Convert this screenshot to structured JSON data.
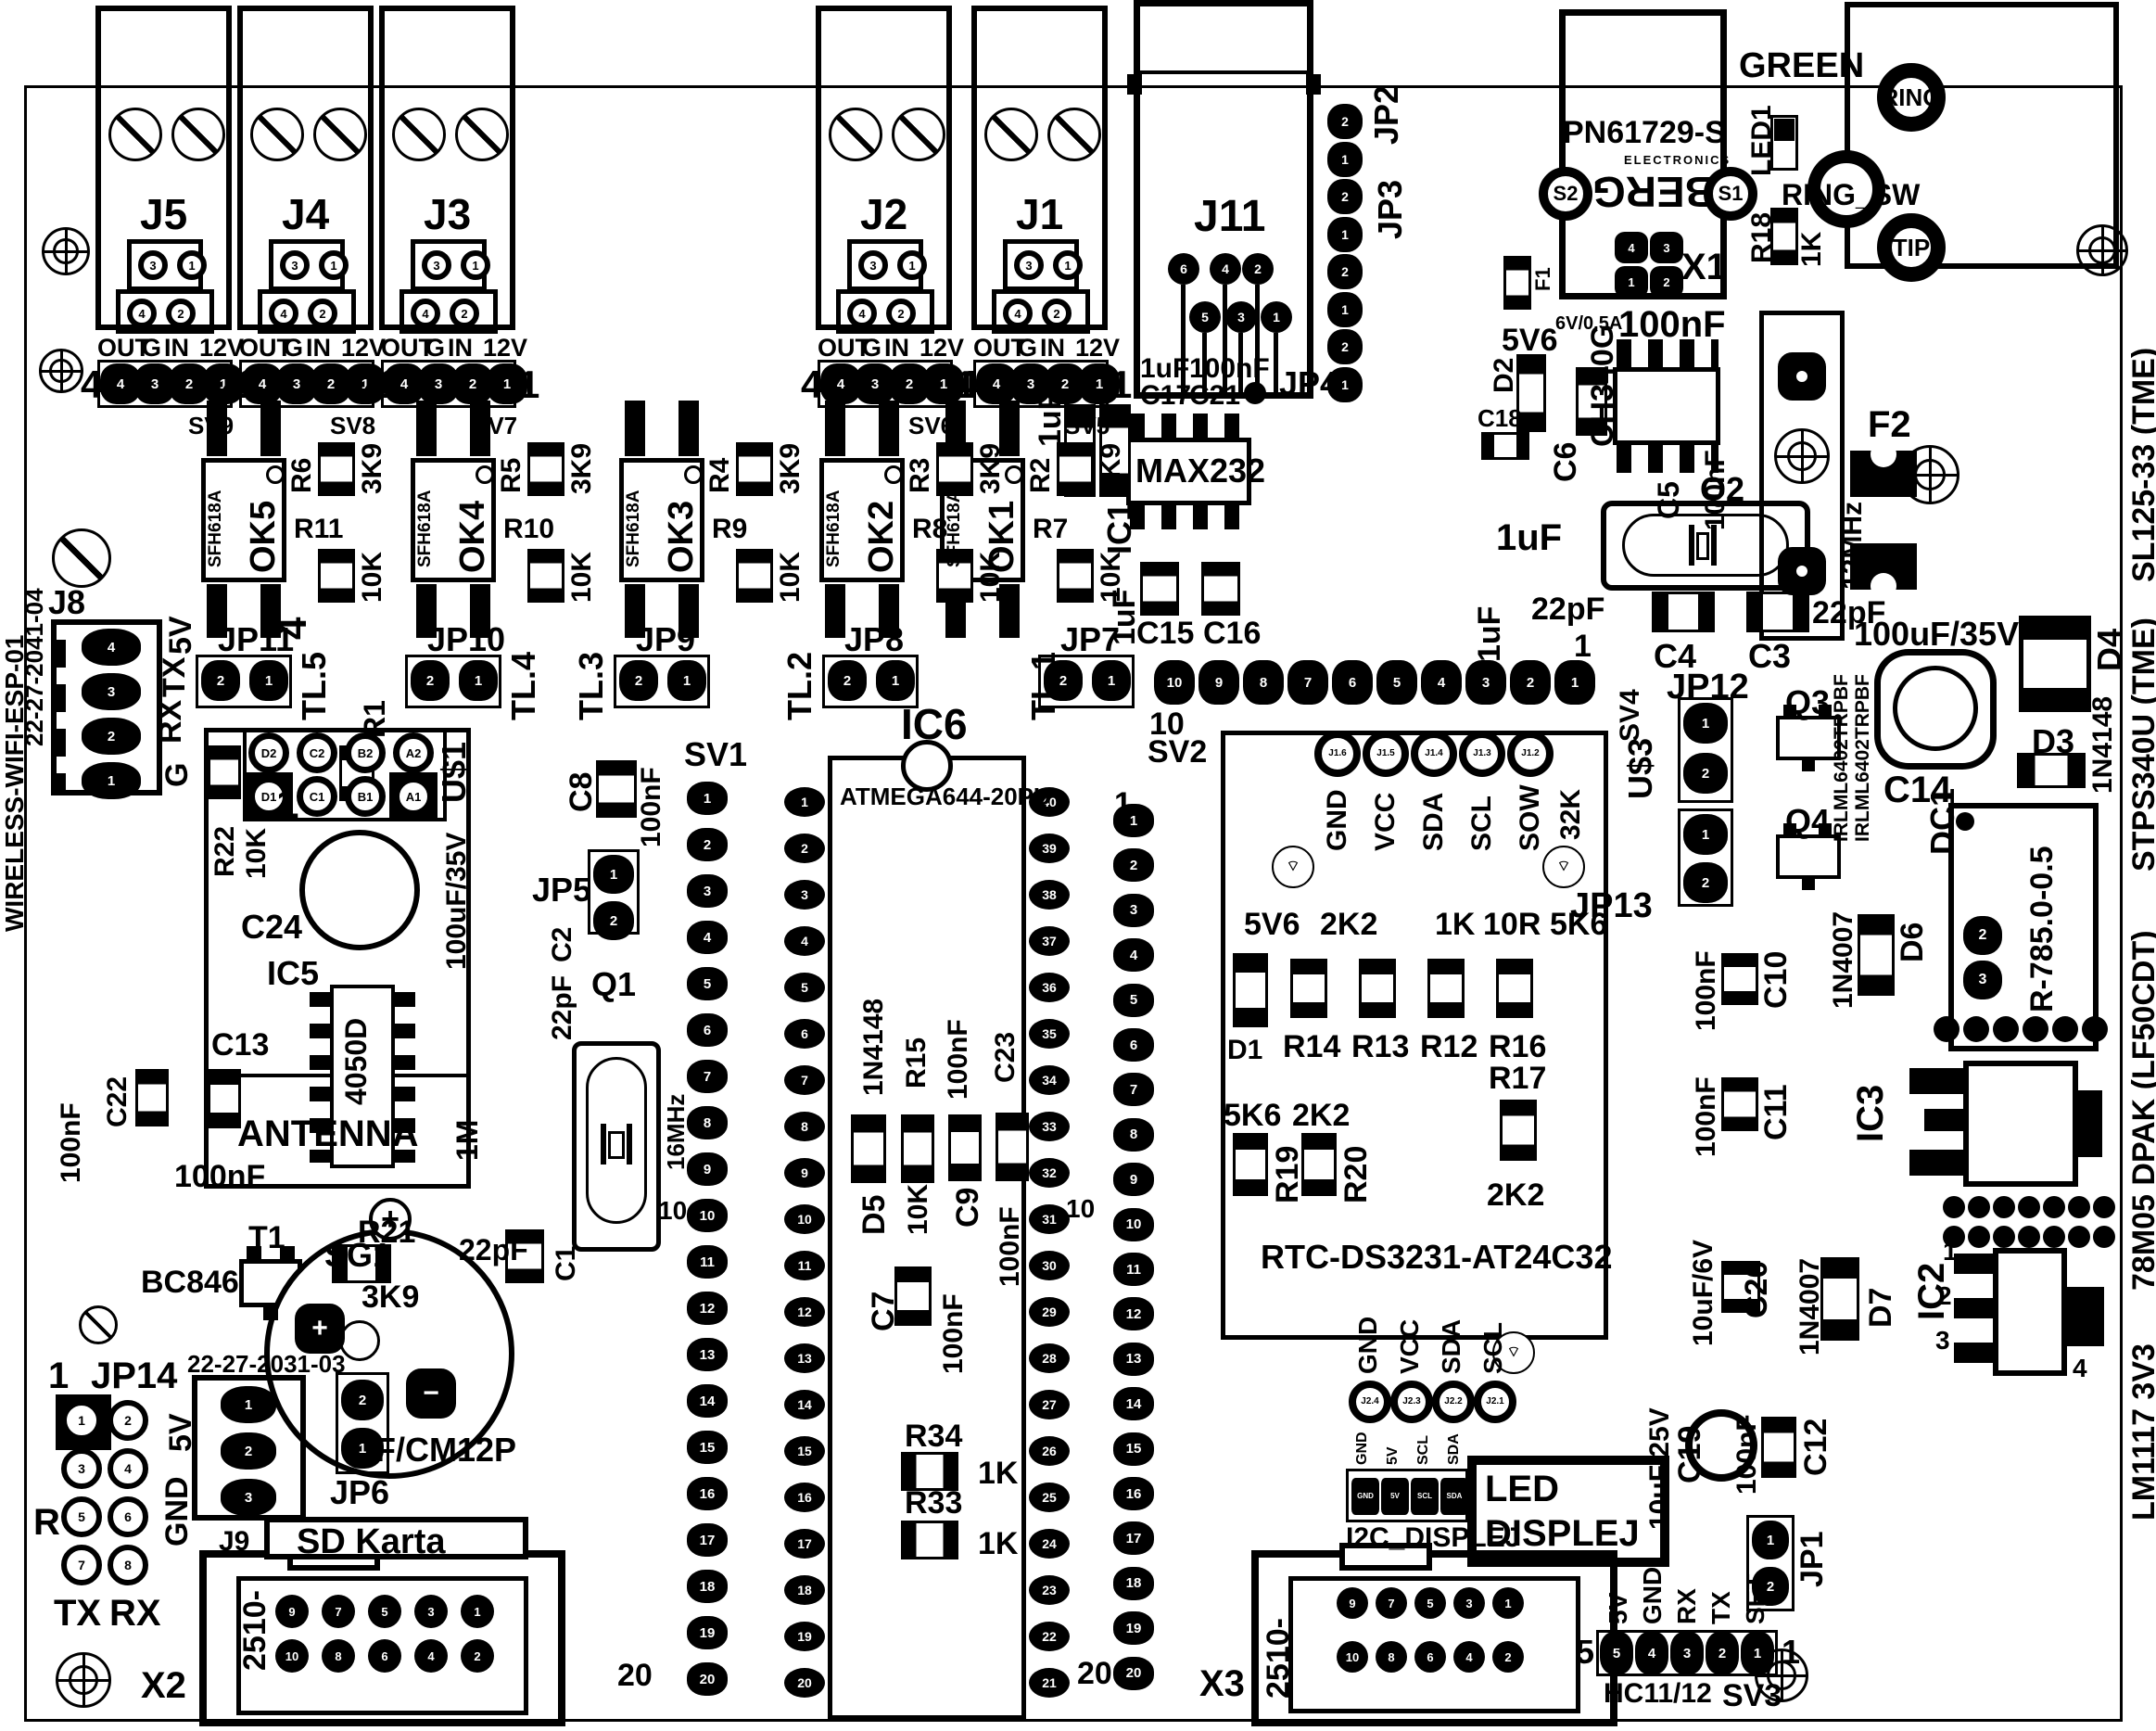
{
  "margins": {
    "left_title": "WIRELESS-WIFI-ESP-01",
    "right_items": [
      "LM1117 3V3",
      "78M05 DPAK (LF50CDT)",
      "STPS340U (TME)",
      "SL125-33 (TME)"
    ]
  },
  "relays": {
    "pin_labels": [
      "OUT",
      "G",
      "IN",
      "12V"
    ],
    "left_num": "4",
    "right_num": "1",
    "terminal_pins": [
      "3",
      "1",
      "4",
      "2"
    ],
    "header_pins": [
      "4",
      "3",
      "2",
      "1"
    ],
    "modules": [
      {
        "ref": "J5",
        "header": "SV9"
      },
      {
        "ref": "J4",
        "header": "SV8"
      },
      {
        "ref": "J3",
        "header": "SV7"
      },
      {
        "ref": "J2",
        "header": "SV6"
      },
      {
        "ref": "J1",
        "header": "SV5"
      }
    ]
  },
  "optos": {
    "part": "SFH618A",
    "modules": [
      {
        "ref": "OK5",
        "r1": "R6",
        "r1v": "3K9",
        "r2": "R11",
        "r2v": "10K"
      },
      {
        "ref": "OK4",
        "r1": "R5",
        "r1v": "3K9",
        "r2": "R10",
        "r2v": "10K"
      },
      {
        "ref": "OK3",
        "r1": "R4",
        "r1v": "3K9",
        "r2": "R9",
        "r2v": "10K"
      },
      {
        "ref": "OK2",
        "r1": "R3",
        "r1v": "3K9",
        "r2": "R8",
        "r2v": "10K"
      },
      {
        "ref": "OK1",
        "r1": "R2",
        "r1v": "3K9",
        "r2": "R7",
        "r2v": "10K"
      }
    ]
  },
  "jumpers": {
    "pad_nums": [
      "2",
      "1"
    ],
    "modules": [
      {
        "ref": "JP11",
        "tl": "TL.5"
      },
      {
        "ref": "JP10",
        "tl": "TL.4"
      },
      {
        "ref": "JP9",
        "tl": "TL.3"
      },
      {
        "ref": "JP8",
        "tl": "TL.2"
      },
      {
        "ref": "JP7",
        "tl": "TL.1"
      }
    ]
  },
  "j11": {
    "ref": "J11",
    "pins_top": [
      "6",
      "4",
      "2"
    ],
    "pins_bottom": [
      "5",
      "3",
      "1"
    ],
    "c17": "C17",
    "c17v": "1uF",
    "c21": "C21",
    "c21v": "100nF"
  },
  "jp_col": {
    "jp2": "JP2",
    "jp3": "JP3",
    "jp4": "JP4",
    "pin_seq": [
      "2",
      "1",
      "2",
      "1",
      "2",
      "1",
      "2",
      "1"
    ]
  },
  "power_in": {
    "f1": "F1",
    "rating": "6V/0.5A",
    "d2": "D2",
    "d2v": "5V6",
    "c18": "C18",
    "c6": "C6",
    "c5": "C5",
    "c5v": "100nF",
    "v1": "1uF",
    "v2": "1uF"
  },
  "usb": {
    "chip": "CH340G",
    "cap": "100nF"
  },
  "pn": {
    "part": "PN61729-S",
    "brand": "BERG",
    "brand_sub": "ELECTRONICS",
    "s1": "S1",
    "s2": "S2",
    "x1": "X1",
    "x1_pins": [
      "4",
      "3",
      "1",
      "2"
    ],
    "green": "GREEN"
  },
  "phone": {
    "led1": "LED1",
    "r18": "R18",
    "r18v": "1K",
    "ring_sw": "RING_SW",
    "ring": "RING",
    "tip": "TIP"
  },
  "serial": {
    "ic": "IC1",
    "part": "MAX232",
    "c15": "C15",
    "c16": "C16",
    "v": "1uF",
    "v2": "1uF"
  },
  "xtal2": {
    "ref": "Q2",
    "freq": "12MHz",
    "c4": "C4",
    "c3": "C3",
    "v": "22pF",
    "v2": "22pF"
  },
  "fuse2": {
    "ref": "F2"
  },
  "rail": {
    "cap": "100uF/35V",
    "c14": "C14",
    "d4": "D4",
    "d3": "D3",
    "d3v": "1N4148",
    "dc1": "DC1",
    "dc1_part": "R-785.0-0.5",
    "dc1_pins": [
      "2",
      "3"
    ],
    "d6": "D6",
    "d6v": "1N4007",
    "d7": "D7",
    "d7v": "1N4007",
    "c10": "C10",
    "c10v": "100nF",
    "c11": "C11",
    "c11v": "100nF",
    "c20": "C20",
    "c20v": "10uF/6V",
    "ic3": "IC3",
    "ic2": "IC2",
    "ic2_pins": [
      "1",
      "2",
      "3",
      "4"
    ]
  },
  "mosfets": {
    "jp12": "JP12",
    "jp12_nums": [
      "1",
      "2"
    ],
    "jp13": "JP13",
    "jp13_nums": [
      "1",
      "2"
    ],
    "q3": "Q3",
    "q4": "Q4",
    "part": "IRLML6402TRPBF"
  },
  "rtc": {
    "title": "RTC-DS3231-AT24C32",
    "ref": "U$3",
    "k32": "32K",
    "top_labels": [
      "GND",
      "VCC",
      "SDA",
      "SCL",
      "SOW"
    ],
    "top_pins": [
      "J1.6",
      "J1.5",
      "J1.4",
      "J1.3",
      "J1.2"
    ],
    "bottom_labels": [
      "GND",
      "VCC",
      "SDA",
      "SCL"
    ],
    "bottom_pins": [
      "J2.4",
      "J2.3",
      "J2.2",
      "J2.1"
    ],
    "d1": "D1",
    "d1v": "5V6",
    "r14": "R14",
    "r14v": "2K2",
    "r13": "R13",
    "r13v": "1K",
    "r12": "R12",
    "r12v": "10R",
    "r16": "R16",
    "r16v": "5K6",
    "r17": "R17",
    "r17v": "2K2",
    "r19": "R19",
    "r19v": "5K6",
    "r20": "R20",
    "r20v": "2K2"
  },
  "sv4": {
    "ref": "SV4",
    "left": "10",
    "right": "1"
  },
  "mcu": {
    "ref": "IC6",
    "part": "ATMEGA644-20PU"
  },
  "sv1": {
    "ref": "SV1",
    "ten": "10",
    "twenty": "20"
  },
  "sv2": {
    "ref": "SV2",
    "one": "1",
    "ten": "10",
    "twenty": "20"
  },
  "esp": {
    "j8": "J8",
    "code": "22-27-2041-04",
    "pin_names": [
      "5V",
      "TX",
      "RX",
      "G"
    ],
    "pins": [
      "4",
      "3",
      "2",
      "1"
    ],
    "four": "4",
    "one": "1"
  },
  "u1": {
    "ref": "U$1",
    "pins": [
      "D2",
      "C2",
      "B2",
      "A2",
      "D1",
      "C1",
      "B1",
      "A1"
    ],
    "r22": "R22",
    "r22v": "10K",
    "c24": "C24",
    "c24v": "100uF/35V",
    "ic5": "IC5",
    "chip": "4050D",
    "antenna": "ANTENNA",
    "c13": "C13",
    "c22": "C22",
    "c22v": "100nF",
    "extra_cap": "100nF",
    "r1": "R1",
    "r1v": "1M"
  },
  "xtal1": {
    "ref": "Q1",
    "freq": "16MHz",
    "jp5": "JP5",
    "jp5_nums": [
      "1",
      "2"
    ],
    "c2": "C2",
    "c2v": "22pF",
    "c1": "C1",
    "c1v": "22pF",
    "c8": "C8",
    "c8v": "100nF"
  },
  "mid": {
    "d5": "D5",
    "d5v": "1N4148",
    "r15": "R15",
    "r15v": "10K",
    "c9": "C9",
    "c9v": "100nF",
    "c23": "C23",
    "c23v": "100nF",
    "c7": "C7",
    "c7v": "100nF",
    "r34": "R34",
    "r34v": "1K",
    "r33": "R33",
    "r33v": "1K"
  },
  "t1": {
    "ref": "T1",
    "part": "BC846"
  },
  "r21": {
    "ref": "R21",
    "v": "3K9"
  },
  "buzzer": {
    "ref": "SG1",
    "part": "F/CM12P",
    "plus": "+",
    "minus": "−"
  },
  "jp14": {
    "ref": "JP14",
    "one": "1",
    "r": "R",
    "tx": "TX",
    "rx": "RX"
  },
  "pwr_conn": {
    "code": "22-27-2031-03",
    "v5": "5V",
    "gnd": "GND",
    "j9": "J9",
    "nums": [
      "1",
      "2",
      "3"
    ]
  },
  "jp6": {
    "ref": "JP6",
    "nums": [
      "2",
      "1"
    ]
  },
  "jp1": {
    "ref": "JP1",
    "nums": [
      "1",
      "2"
    ]
  },
  "sd1": {
    "title": "SD Karta",
    "ref": "X2",
    "part": "2510-",
    "row1": [
      "9",
      "7",
      "5",
      "3",
      "1"
    ],
    "row2": [
      "10",
      "8",
      "6",
      "4",
      "2"
    ]
  },
  "sd2": {
    "ref": "X3",
    "part": "2510-",
    "row1": [
      "9",
      "7",
      "5",
      "3",
      "1"
    ],
    "row2": [
      "10",
      "8",
      "6",
      "4",
      "2"
    ]
  },
  "i2c": {
    "ref": "I2C_DISPLEJ",
    "pins": [
      "GND",
      "5V",
      "SCL",
      "SDA"
    ]
  },
  "led_display": {
    "l1": "LED",
    "l2": "DISPLEJ"
  },
  "out_caps": {
    "c19": "C19",
    "c19v": "10uF/25V",
    "c12": "C12",
    "c12v": "100nF"
  },
  "sv3": {
    "ref": "SV3",
    "hc": "HC11/12",
    "labels": [
      "5V",
      "GND",
      "RX",
      "TX",
      "SET"
    ],
    "five": "5",
    "one": "1"
  },
  "pin_ranges": {
    "sv1": [
      1,
      20
    ],
    "sv2": [
      1,
      20
    ],
    "ic6_left": [
      1,
      20
    ],
    "ic6_right": [
      40,
      21
    ],
    "sv4": [
      10,
      1
    ],
    "jp14": [
      1,
      8
    ],
    "sv3": [
      5,
      1
    ]
  }
}
